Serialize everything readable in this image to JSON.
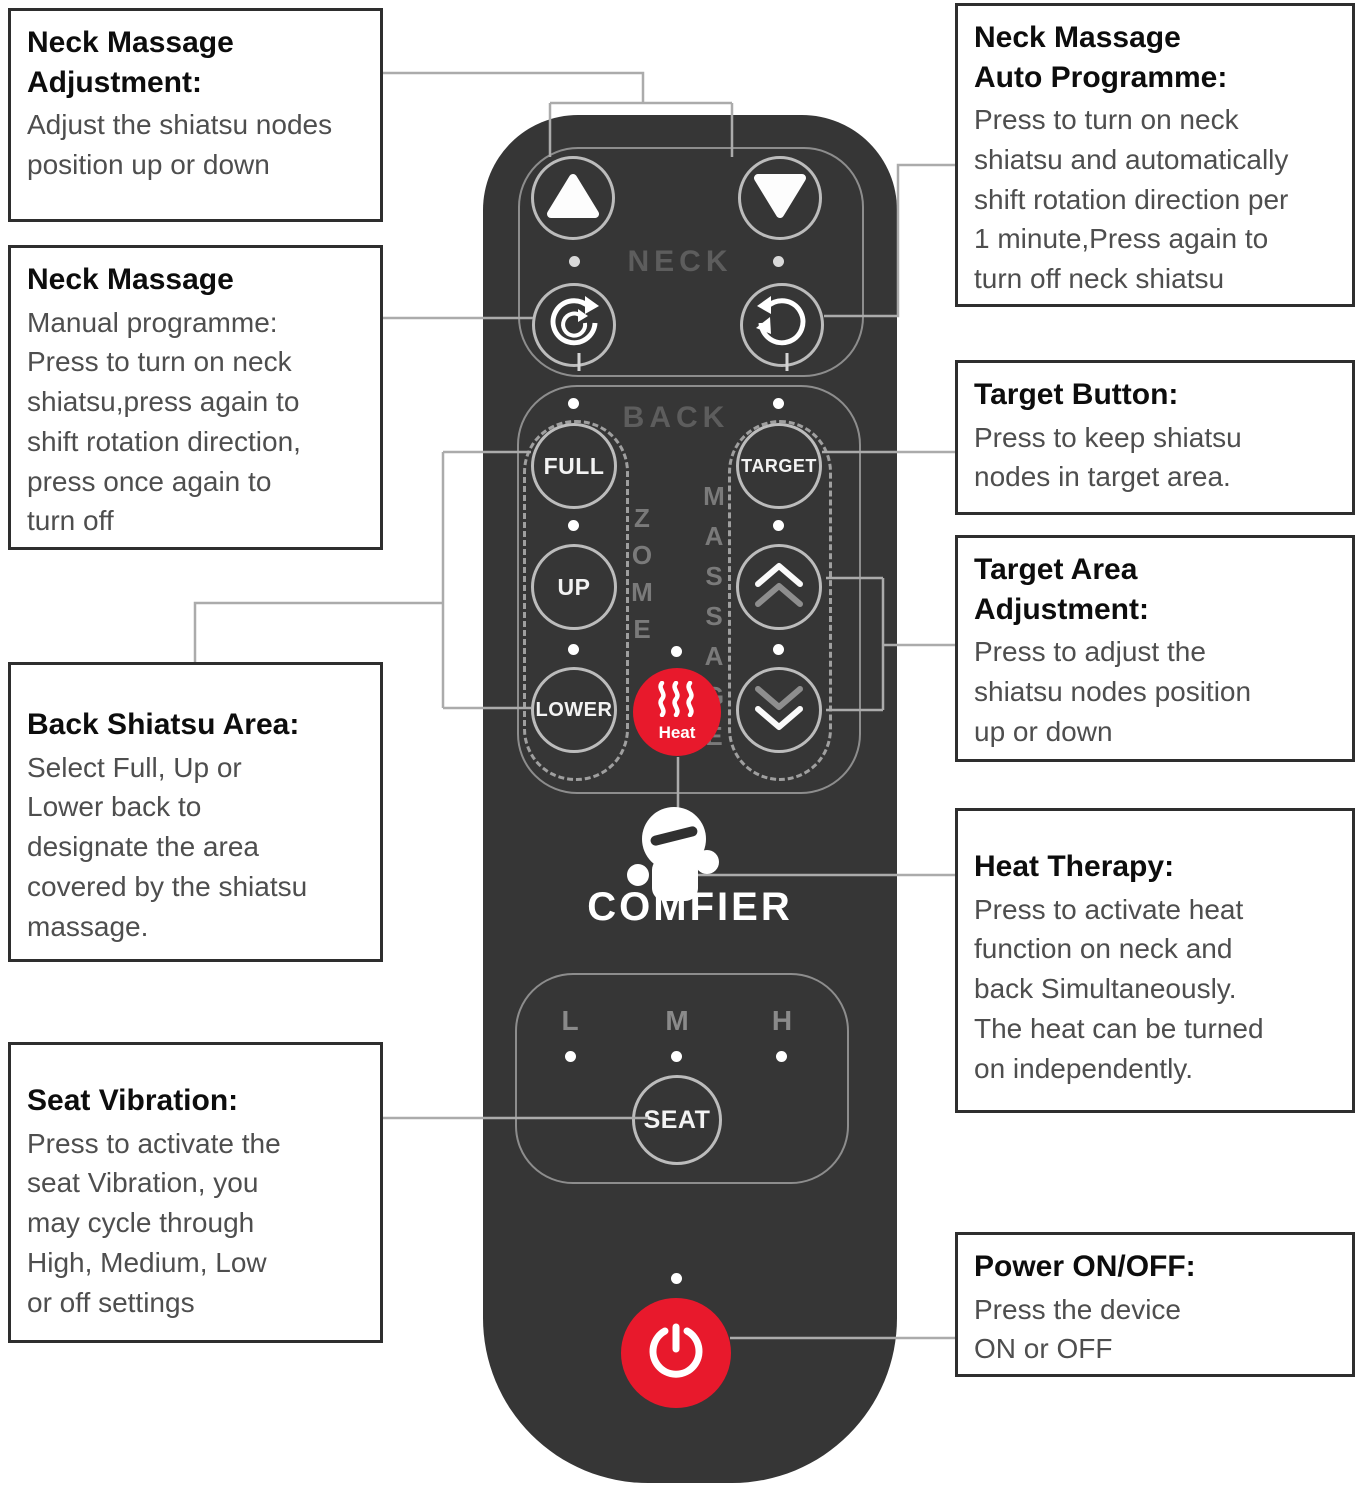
{
  "callouts": {
    "neck_adjustment": {
      "title": "Neck Massage\nAdjustment:",
      "body": "Adjust the shiatsu nodes\nposition up or down"
    },
    "neck_manual": {
      "title": "Neck Massage",
      "body": "Manual programme:\nPress to turn on neck\nshiatsu,press again to\nshift rotation direction,\npress once again to\nturn off"
    },
    "back_shiatsu": {
      "title": "Back Shiatsu Area:",
      "body": "Select Full, Up or\nLower back to\ndesignate the area\ncovered by the shiatsu\nmassage."
    },
    "seat_vibration": {
      "title": "Seat Vibration:",
      "body": "Press to activate the\nseat Vibration, you\nmay cycle through\nHigh, Medium, Low\nor off settings"
    },
    "neck_auto": {
      "title": "Neck Massage\nAuto Programme:",
      "body": "Press to turn on neck\nshiatsu and automatically\nshift rotation direction per\n1 minute,Press again to\nturn off neck shiatsu"
    },
    "target_button": {
      "title": "Target Button:",
      "body": "Press to keep shiatsu\nnodes in target area."
    },
    "target_area": {
      "title": "Target Area\nAdjustment:",
      "body": "Press to adjust the\nshiatsu nodes position\nup or down"
    },
    "heat_therapy": {
      "title": "Heat Therapy:",
      "body": "Press to activate heat\nfunction on neck and\nback Simultaneously.\nThe heat can be turned\non independently."
    },
    "power": {
      "title": "Power ON/OFF:",
      "body": "Press the device\nON or OFF"
    }
  },
  "remote": {
    "brand": "COMFIER",
    "neck_label": "NECK",
    "back_label": "BACK",
    "zone_vertical": "ZOME",
    "massage_vertical": "MASSAGE",
    "full_label": "FULL",
    "up_label": "UP",
    "lower_label": "LOWER",
    "target_label": "TARGET",
    "heat_label": "Heat",
    "seat": {
      "low": "L",
      "medium": "M",
      "high": "H",
      "button": "SEAT"
    }
  },
  "colors": {
    "accent_red": "#e8192c",
    "remote_body": "#363636",
    "connector": "#ababab",
    "button_ring": "#bcbcbc"
  }
}
